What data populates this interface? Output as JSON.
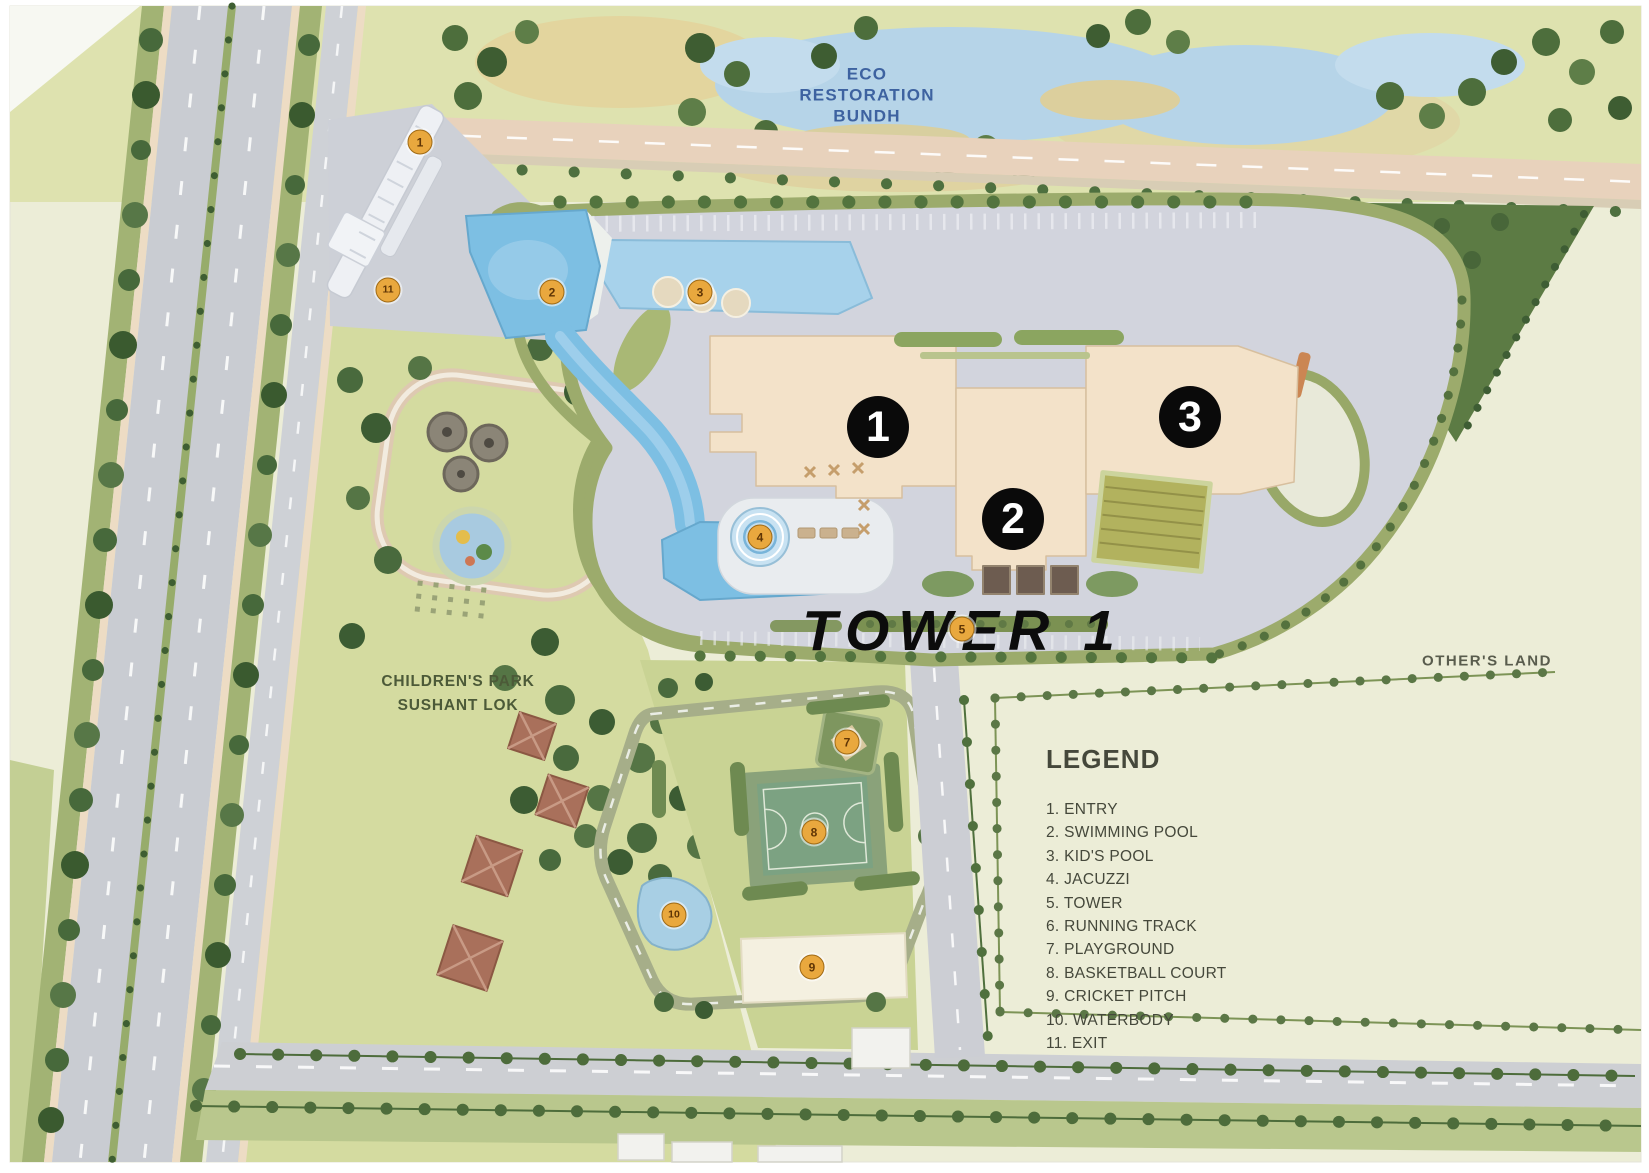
{
  "labels": {
    "eco_line1": "ECO",
    "eco_line2": "RESTORATION",
    "eco_line3": "BUNDH",
    "childrens_park_line1": "CHILDREN'S PARK",
    "childrens_park_line2": "SUSHANT LOK",
    "tower": "TOWER 1",
    "others_land": "OTHER'S LAND"
  },
  "legend": {
    "title": "LEGEND",
    "items": [
      "1. ENTRY",
      "2. SWIMMING POOL",
      "3. KID'S POOL",
      "4. JACUZZI",
      "5. TOWER",
      "6. RUNNING TRACK",
      "7. PLAYGROUND",
      "8. BASKETBALL COURT",
      "9. CRICKET PITCH",
      "10. WATERBODY",
      "11. EXIT"
    ]
  },
  "hotspots": [
    {
      "label": "1"
    },
    {
      "label": "2"
    },
    {
      "label": "3"
    }
  ],
  "plan_markers": [
    {
      "label": "1",
      "feature": "ENTRY"
    },
    {
      "label": "11",
      "feature": "EXIT"
    },
    {
      "label": "2",
      "feature": "SWIMMING POOL"
    },
    {
      "label": "3",
      "feature": "KID'S POOL"
    },
    {
      "label": "4",
      "feature": "JACUZZI"
    },
    {
      "label": "5",
      "feature": "TOWER"
    },
    {
      "label": "7",
      "feature": "PLAYGROUND"
    },
    {
      "label": "8",
      "feature": "BASKETBALL COURT"
    },
    {
      "label": "10",
      "feature": "WATERBODY"
    },
    {
      "label": "9",
      "feature": "CRICKET PITCH"
    }
  ],
  "colors": {
    "water": "#b7d4e7",
    "pool": "#7fbfe2",
    "building": "#f3e2ca",
    "parking": "#d2d4dd",
    "lawn": "#c9d396",
    "park_green": "#d4dba2",
    "road_gray": "#c9ccd2",
    "tree_dark": "#4e6e3d",
    "hotspot_bg": "#0a0a0a",
    "marker_orange": "#e9a83e",
    "cream_land": "#ecedd8"
  }
}
